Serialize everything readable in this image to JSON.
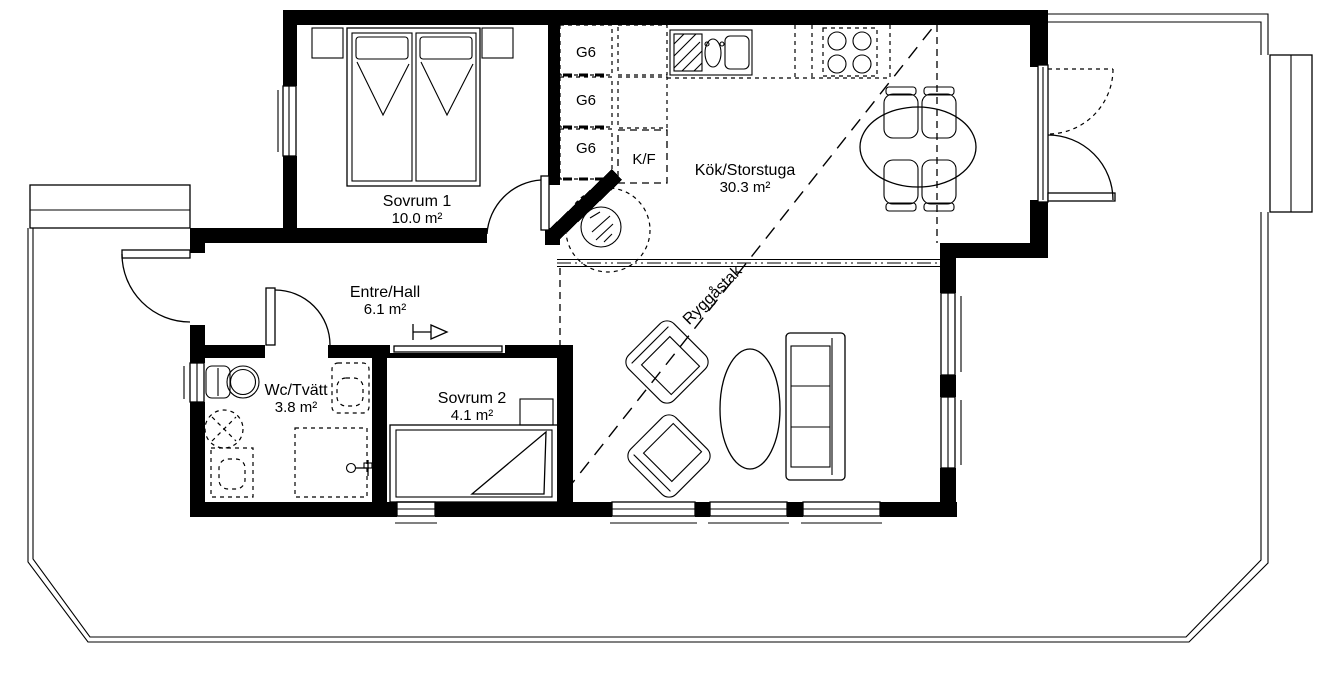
{
  "floorplan": {
    "rooms": [
      {
        "name": "Sovrum 1",
        "area": "10.0 m²"
      },
      {
        "name": "Entre/Hall",
        "area": "6.1 m²"
      },
      {
        "name": "Wc/Tvätt",
        "area": "3.8 m²"
      },
      {
        "name": "Sovrum 2",
        "area": "4.1 m²"
      },
      {
        "name": "Kök/Storstuga",
        "area": "30.3 m²"
      }
    ],
    "labels": {
      "ridge": "Ryggåstak",
      "fridge_freezer": "K/F",
      "wardrobes": [
        "G6",
        "G6",
        "G6"
      ]
    },
    "colors": {
      "line": "#000000",
      "background": "#ffffff"
    }
  }
}
